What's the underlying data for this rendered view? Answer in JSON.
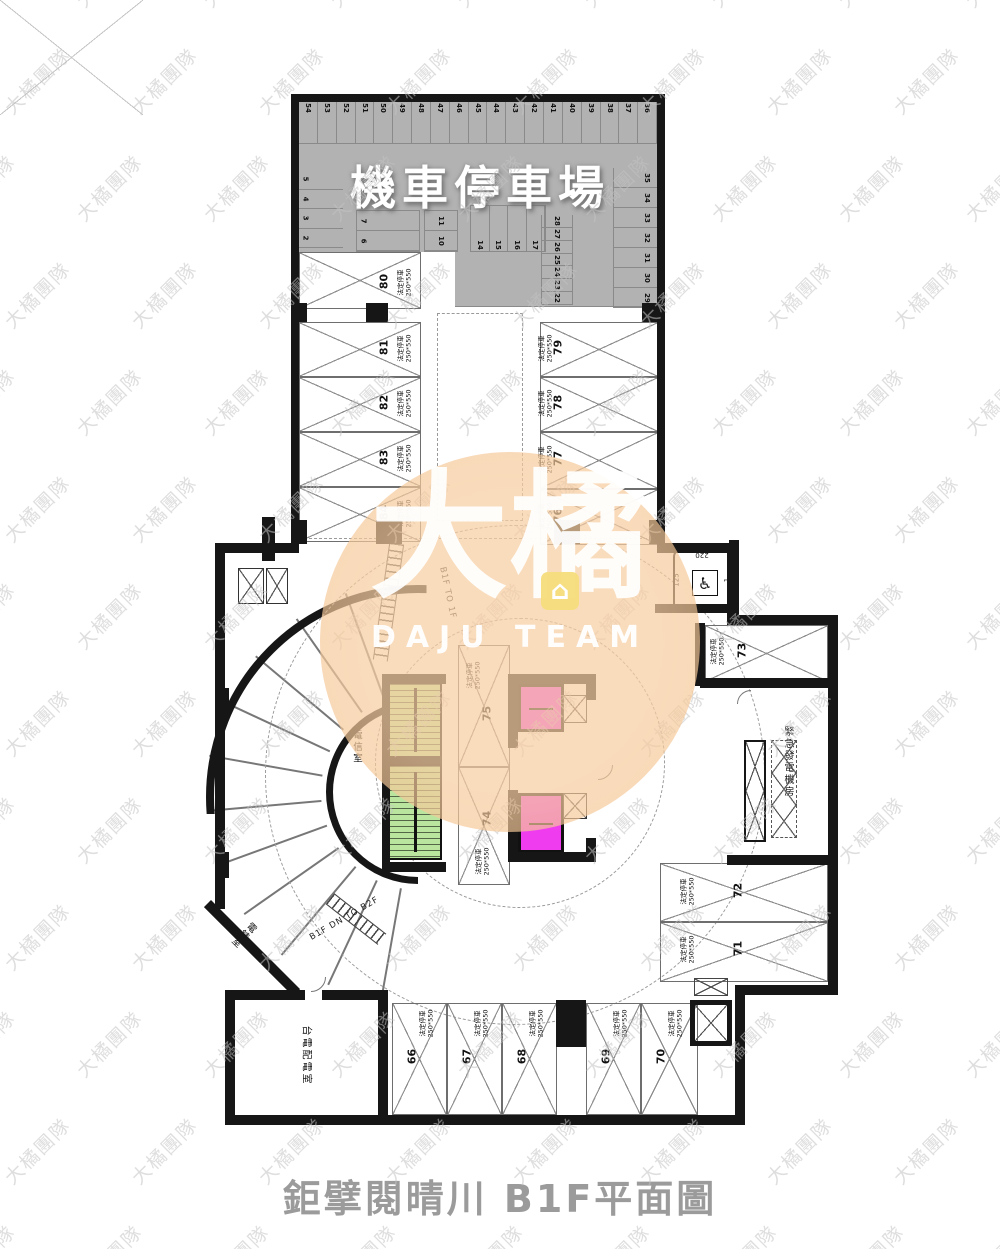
{
  "title": "鉅擘閱晴川 B1F平面圖",
  "watermark": {
    "text": "大橘團隊"
  },
  "logo": {
    "brand": "大橘",
    "team": "DAJU TEAM",
    "house_icon": "⌂"
  },
  "moto_area": {
    "label": "機車停車場",
    "top_row": [
      "54",
      "53",
      "52",
      "51",
      "50",
      "49",
      "48",
      "47",
      "46",
      "45",
      "44",
      "43",
      "42",
      "41",
      "40",
      "39",
      "38",
      "37",
      "36"
    ],
    "left_col": [
      "5",
      "4",
      "3",
      "2"
    ],
    "cluster_a": [
      "7",
      "6"
    ],
    "cluster_b": [
      "11",
      "10"
    ],
    "mid_row": [
      "14",
      "15",
      "16",
      "17"
    ],
    "inner_col": [
      "28",
      "27",
      "26",
      "25",
      "24",
      "23",
      "22"
    ],
    "right_col": [
      "35",
      "34",
      "33",
      "32",
      "31",
      "30",
      "29"
    ]
  },
  "stall_label": {
    "type": "法定停車",
    "size": "250*550"
  },
  "spots": {
    "left": [
      "80",
      "81",
      "82",
      "83",
      "84"
    ],
    "right": [
      "79",
      "78",
      "77",
      "76"
    ],
    "center": [
      "75",
      "74"
    ],
    "east": [
      "73",
      "72",
      "71"
    ],
    "south": [
      "66",
      "67",
      "68",
      "69",
      "70"
    ]
  },
  "accessible": {
    "width": "220",
    "depth": "125",
    "num": "1"
  },
  "rooms": {
    "telecom": "電信室",
    "generator": "緊急發電機房",
    "meter": "電錶室",
    "taipower": "台電配電室"
  },
  "ramp": {
    "up": "B1F TO 1F",
    "down": "B1F DN TO B2F"
  },
  "colors": {
    "moto_gray": "#b2b2b2",
    "stair_green": "#b9e59f",
    "elevator_magenta": "#ee3cee",
    "logo_orange": "rgba(243,189,133,0.66)",
    "wall_black": "#161616"
  }
}
